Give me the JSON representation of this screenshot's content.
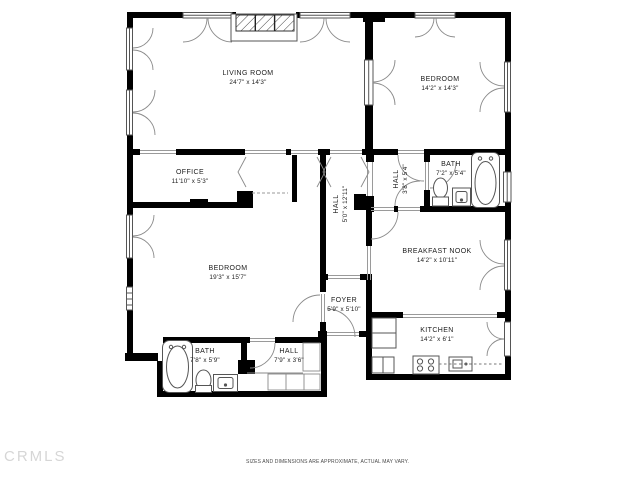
{
  "footer": {
    "logo": "CRMLS",
    "disclaimer": "SIZES AND DIMENSIONS ARE APPROXIMATE, ACTUAL MAY VARY."
  },
  "rooms": {
    "living_room": {
      "name": "LIVING ROOM",
      "dims": "24'7\" x 14'3\""
    },
    "bedroom_tr": {
      "name": "BEDROOM",
      "dims": "14'2\" x 14'3\""
    },
    "office": {
      "name": "OFFICE",
      "dims": "11'10\" x 5'3\""
    },
    "hall_center": {
      "name": "HALL",
      "dims": "5'0\" x 12'11\""
    },
    "hall_small": {
      "name": "HALL",
      "dims": "3'8\" x 5'4\""
    },
    "bath_tr": {
      "name": "BATH",
      "dims": "7'2\" x 5'4\""
    },
    "bedroom_left": {
      "name": "BEDROOM",
      "dims": "19'3\" x 15'7\""
    },
    "breakfast_nook": {
      "name": "BREAKFAST NOOK",
      "dims": "14'2\" x 10'11\""
    },
    "foyer": {
      "name": "FOYER",
      "dims": "5'9\" x 5'10\""
    },
    "kitchen": {
      "name": "KITCHEN",
      "dims": "14'2\" x 6'1\""
    },
    "bath_bl": {
      "name": "BATH",
      "dims": "7'8\" x 5'9\""
    },
    "hall_bl": {
      "name": "HALL",
      "dims": "7'9\" x 3'6\""
    }
  },
  "colors": {
    "wall": "#000000",
    "fixture_line": "#555555",
    "swing_line": "#888888",
    "logo": "#d6d6d6",
    "disclaimer": "#4a4a4a"
  }
}
